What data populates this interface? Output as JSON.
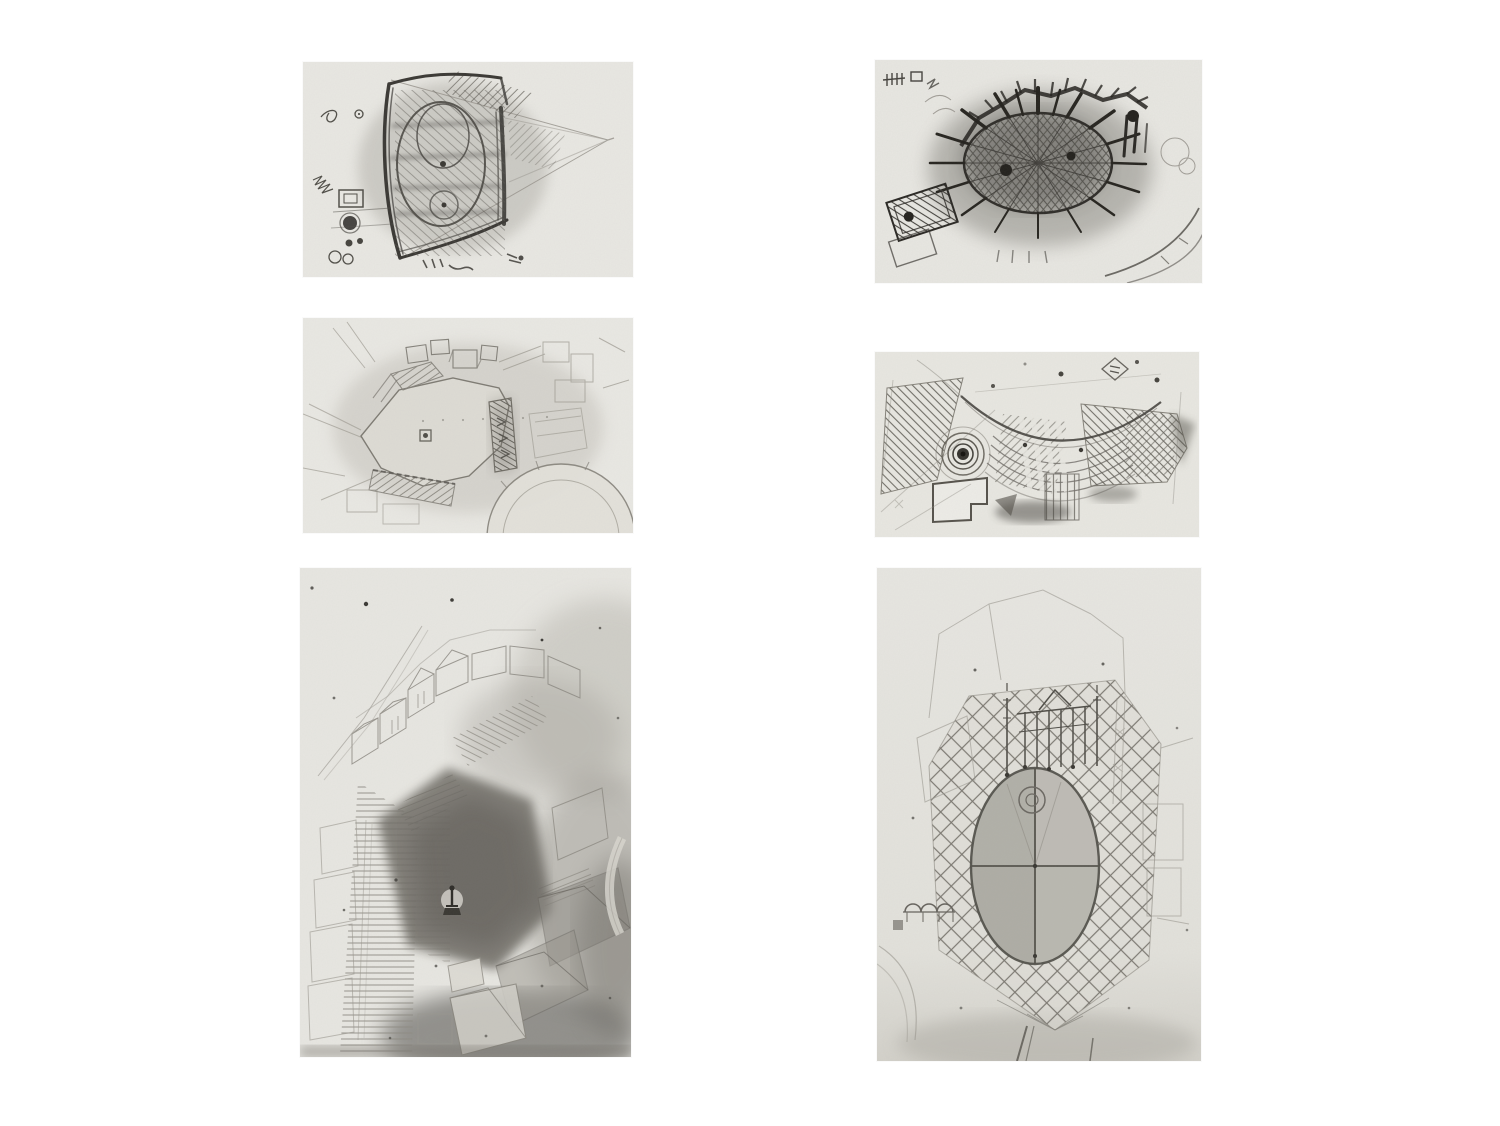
{
  "page": {
    "kind": "scanned book plate",
    "content": "six grayscale pencil sketch studies of urban squares arranged in a 2-by-3 grid on a white page",
    "visible_text": "",
    "grid": {
      "columns": 2,
      "rows": 3
    }
  },
  "colors": {
    "page-bg": "#ffffff",
    "paper": "#e8e7e2",
    "paper-2": "#e9e8e3",
    "ink-dark": "#2e2c28",
    "ink-mid": "#55534c",
    "ink-light": "#8f8c85"
  },
  "panels": [
    {
      "id": "panel-tl",
      "position": "top-left",
      "description": "Dense pencil plan study of a trapezoidal piazza containing an egg-shaped oval, heavy hatched edges, perspective lines converging to a vanishing point at the right, small square and circular doodles at the lower left"
    },
    {
      "id": "panel-tr",
      "position": "top-right",
      "description": "Very dark pencil plan study of an oval piazza with radial spokes and crosshatching, bold wall strokes radiating outward, a hatched rectangular building block at the left and curved road arcs at the lower right"
    },
    {
      "id": "panel-ml",
      "position": "middle-left",
      "description": "Light pencil plan of a polygonal open square with a small square fountain marker at its centre, rows of building blocks and hatched strips above, a dark hatched corridor right of centre and a large faint circular plaza at the lower right"
    },
    {
      "id": "panel-mr",
      "position": "middle-right",
      "description": "Pencil paving study with a large sweeping arc, blank paper above it, bands of diagonal and herringbone hatching below, a dark concentric-circle bullseye at the left and a small diamond doodle near the top right"
    },
    {
      "id": "panel-bl",
      "position": "bottom-left",
      "description": "Tall faint aerial perspective of a town square: a dark shaded pentagonal plaza with a tiny statue, long stair flights on the left, an arc of wireframe buildings above and smudged dark buildings to the right"
    },
    {
      "id": "panel-br",
      "position": "bottom-right",
      "description": "Tall pencil study of an oval piazza divided into quadrants, surrounded by a diamond lattice paving field, a small colonnaded aedicule at the top, an arched arcade at the left and faint building outlines around"
    }
  ]
}
